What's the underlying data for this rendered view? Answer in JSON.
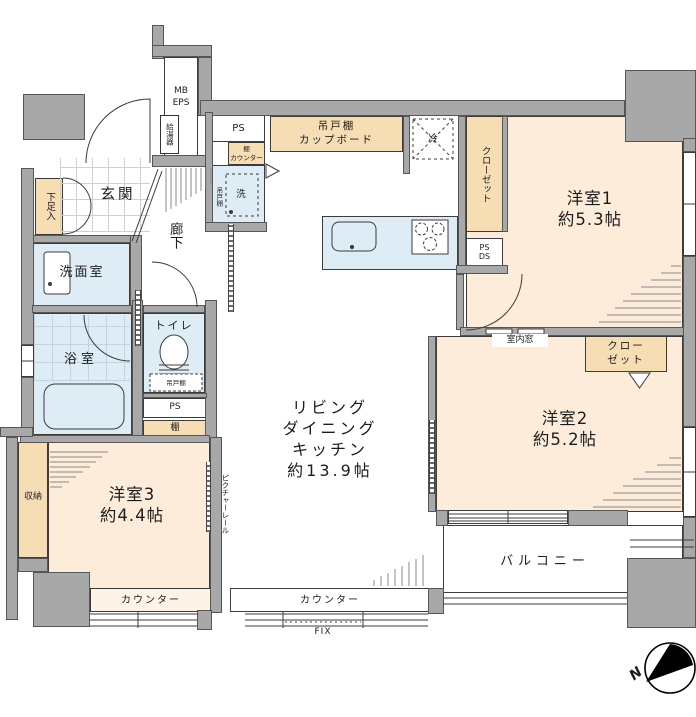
{
  "plan_type": "apartment-floor-plan",
  "colors": {
    "wall_gray": "#a8a8a8",
    "room_peach": "#fcecd9",
    "cabinet_peach": "#f7ddb4",
    "counter_light": "#fdf3e6",
    "wet_blue": "#ddecf5",
    "line": "#3c3c3c"
  },
  "rooms": {
    "room1": {
      "name": "洋室1",
      "size": "約5.3帖"
    },
    "room2": {
      "name": "洋室2",
      "size": "約5.2帖"
    },
    "room3": {
      "name": "洋室3",
      "size": "約4.4帖"
    },
    "ldk": {
      "line1": "リビング",
      "line2": "ダイニング",
      "line3": "キッチン",
      "size": "約13.9帖"
    },
    "balcony": {
      "name": "バルコニー"
    },
    "genkan": {
      "name": "玄関"
    },
    "hallway": {
      "name": "廊下"
    },
    "washroom": {
      "name": "洗面室"
    },
    "bathroom": {
      "name": "浴室"
    },
    "toilet": {
      "name": "トイレ"
    },
    "storage": {
      "name": "収納"
    }
  },
  "fixtures": {
    "mb_eps": {
      "line1": "MB",
      "line2": "EPS"
    },
    "water_heater": "給湯器",
    "ps_top": "PS",
    "shelf_counter": {
      "line1": "棚",
      "line2": "カウンター"
    },
    "hanging_shelf_laundry": "吊戸棚",
    "washer": "洗",
    "cupboard": {
      "line1": "吊戸棚",
      "line2": "カップボード"
    },
    "fridge": "冷",
    "closet1": "クローゼット",
    "ps_ds": {
      "line1": "PS",
      "line2": "DS"
    },
    "shoe_cabinet": "下足入",
    "hanging_shelf_toilet": "吊戸棚",
    "ps_mid": "PS",
    "shelf": "棚",
    "interior_window": "室内窓",
    "closet2": {
      "line1": "クロー",
      "line2": "ゼット"
    },
    "picture_rail": "ピクチャーレール",
    "counter_room3": "カウンター",
    "counter_ldk": "カウンター",
    "fix_window": "FIX",
    "compass_north": "N"
  }
}
